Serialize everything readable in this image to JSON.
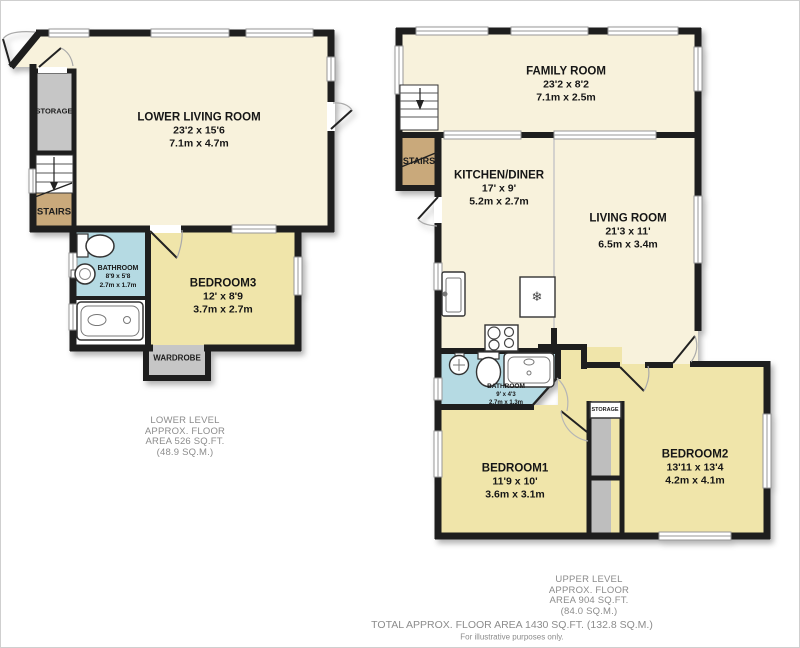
{
  "colors": {
    "cream": "#F8F2DC",
    "yellow": "#F0E5AA",
    "blue": "#B5DAE3",
    "tan": "#C9A97B",
    "gray": "#C6C6C6",
    "wall": "#1E1E1E",
    "footer_text": "#8C8C8C"
  },
  "icons": {
    "fridge": "❄"
  },
  "lower": {
    "living": {
      "name": "LOWER LIVING ROOM",
      "ft": "23'2 x 15'6",
      "m": "7.1m x 4.7m"
    },
    "storage": {
      "name": "STORAGE"
    },
    "stairs": {
      "name": "STAIRS"
    },
    "bathroom": {
      "name": "BATHROOM",
      "ft": "8'9 x 5'8",
      "m": "2.7m x 1.7m"
    },
    "bedroom3": {
      "name": "BEDROOM3",
      "ft": "12' x 8'9",
      "m": "3.7m x 2.7m"
    },
    "wardrobe": {
      "name": "WARDROBE"
    },
    "footer": {
      "l1": "LOWER LEVEL",
      "l2": "APPROX. FLOOR",
      "l3": "AREA 526 SQ.FT.",
      "l4": "(48.9 SQ.M.)"
    }
  },
  "upper": {
    "family": {
      "name": "FAMILY ROOM",
      "ft": "23'2 x 8'2",
      "m": "7.1m x 2.5m"
    },
    "stairs": {
      "name": "STAIRS"
    },
    "kitchen": {
      "name": "KITCHEN/DINER",
      "ft": "17' x 9'",
      "m": "5.2m x 2.7m"
    },
    "living": {
      "name": "LIVING ROOM",
      "ft": "21'3 x 11'",
      "m": "6.5m x 3.4m"
    },
    "bathroom": {
      "name": "BATHROOM",
      "ft": "9' x 4'3",
      "m": "2.7m x 1.3m"
    },
    "bedroom1": {
      "name": "BEDROOM1",
      "ft": "11'9 x 10'",
      "m": "3.6m x 3.1m"
    },
    "bedroom2": {
      "name": "BEDROOM2",
      "ft": "13'11 x 13'4",
      "m": "4.2m x 4.1m"
    },
    "storage": {
      "name": "STORAGE"
    },
    "footer": {
      "l1": "UPPER LEVEL",
      "l2": "APPROX. FLOOR",
      "l3": "AREA 904 SQ.FT.",
      "l4": "(84.0 SQ.M.)"
    }
  },
  "totals": {
    "total": "TOTAL APPROX. FLOOR AREA 1430 SQ.FT. (132.8 SQ.M.)",
    "disclaimer": "For illustrative purposes only."
  }
}
